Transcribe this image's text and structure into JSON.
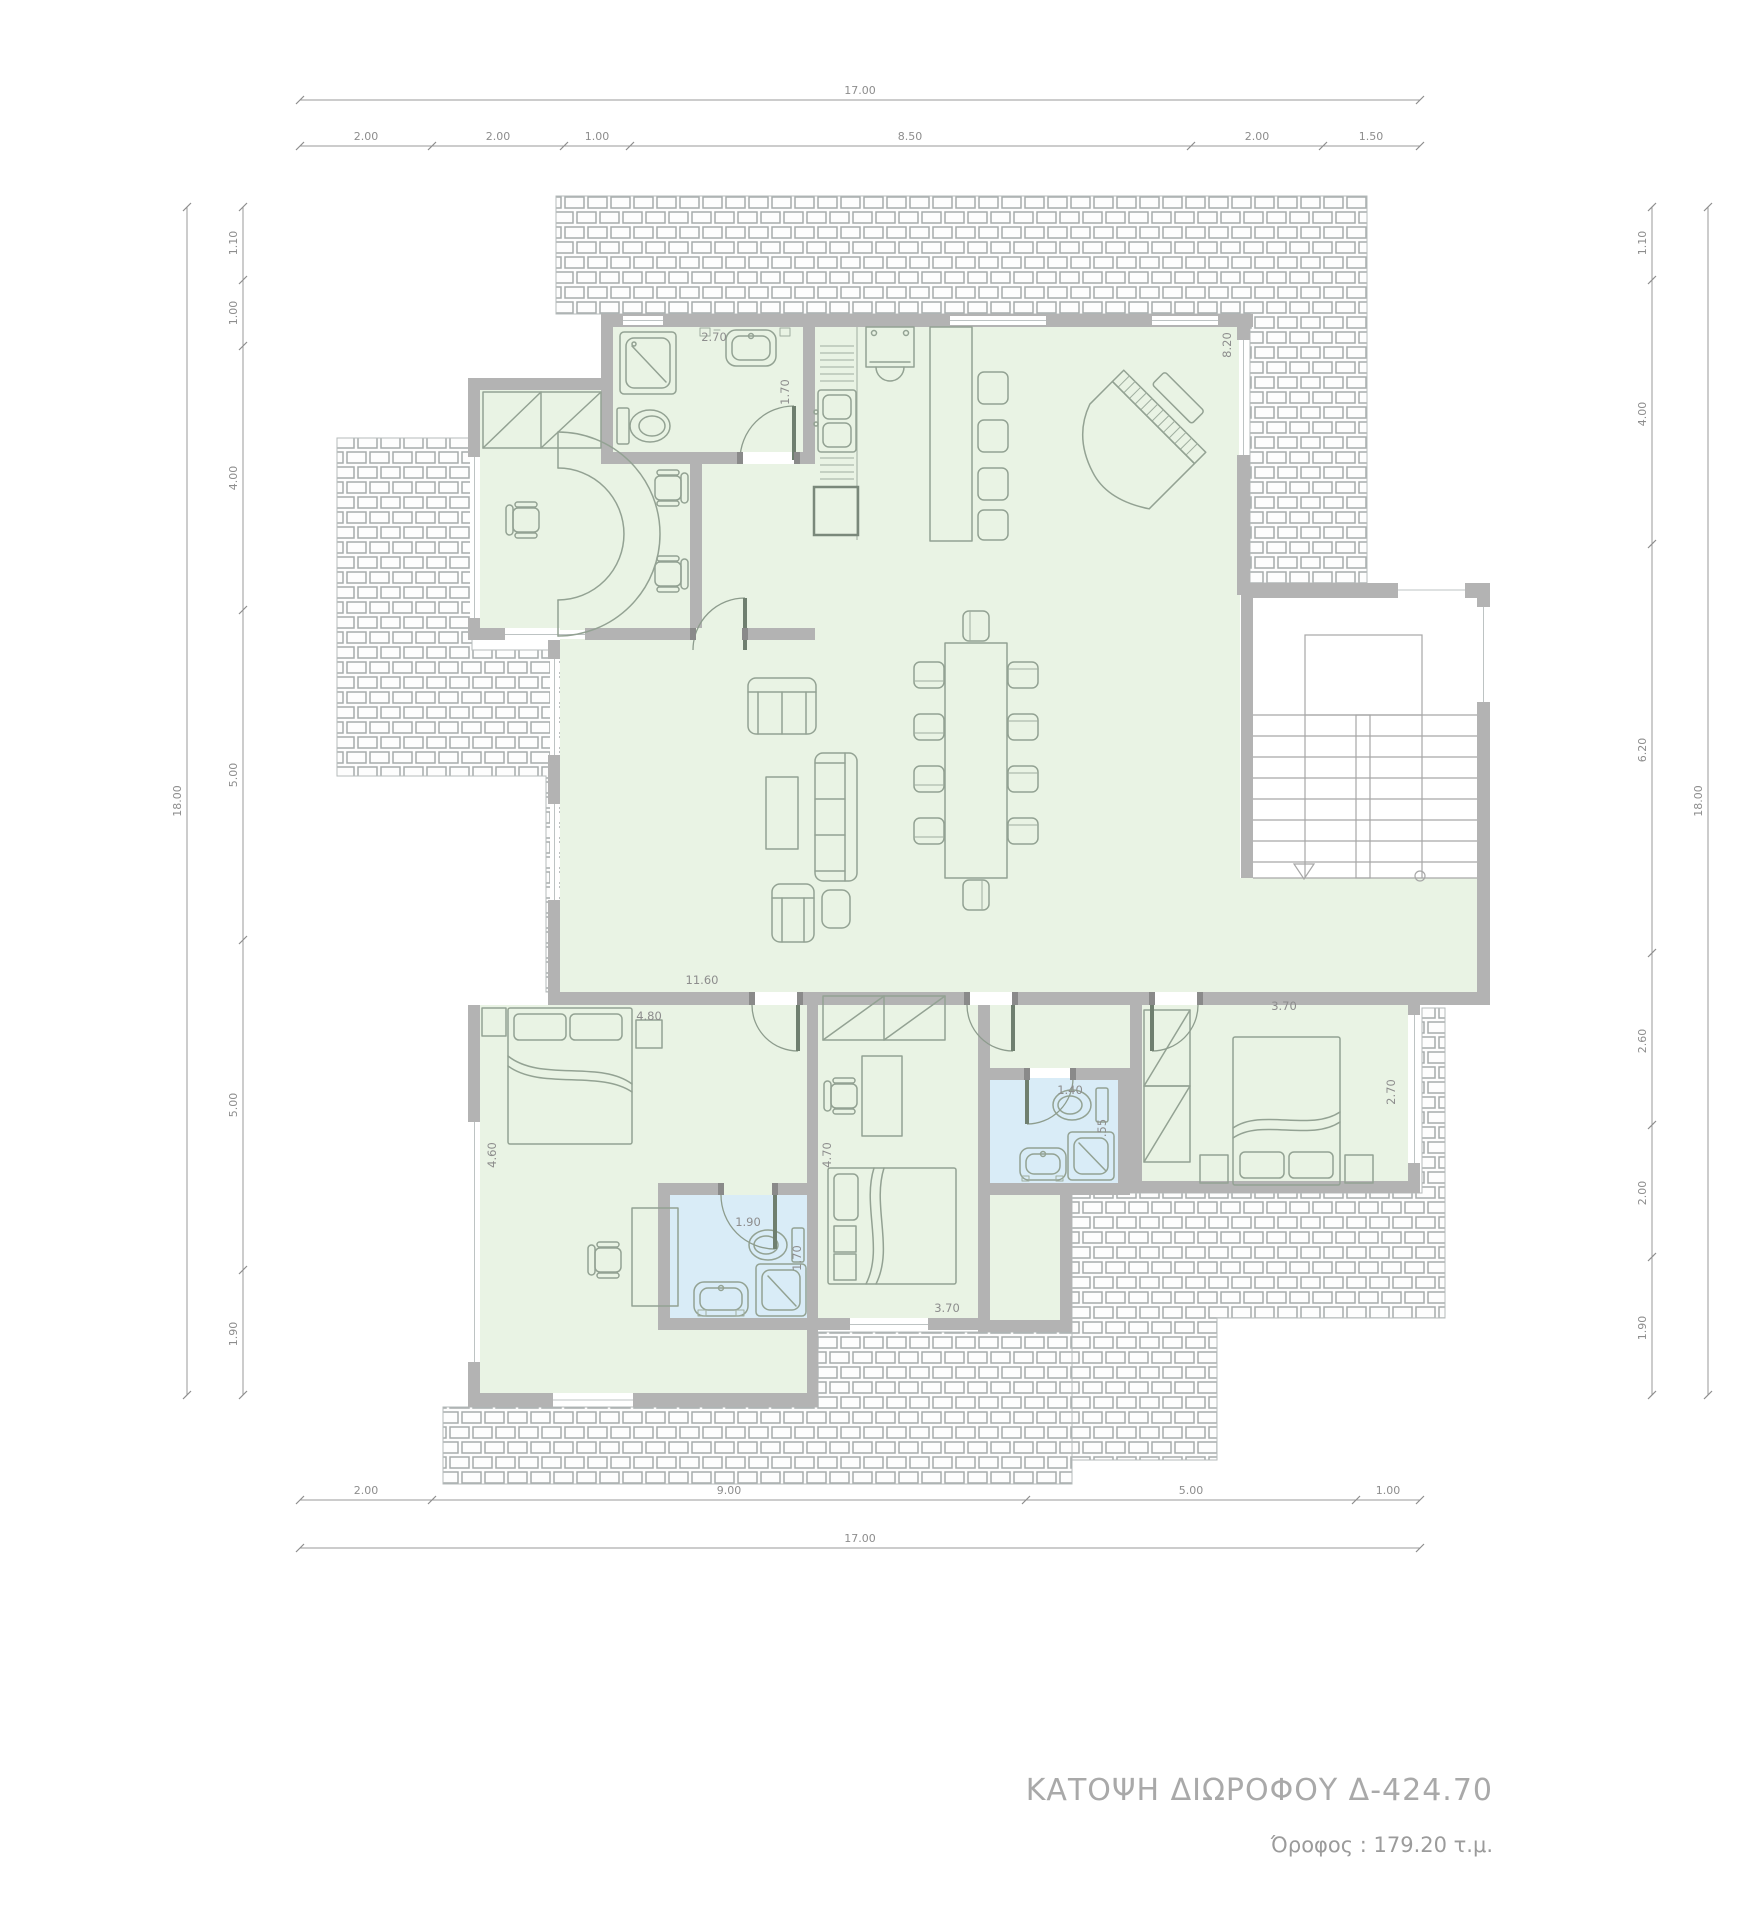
{
  "title": {
    "text": "ΚΑΤΟΨΗ ΔΙΩΡΟΦΟΥ Δ-424.70",
    "subtitle": "Όροφος : 179.20 τ.μ."
  },
  "colors": {
    "room_fill": "#e9f3e4",
    "bath_fill": "#d9ecf7",
    "wall": "#b3b3b3",
    "dimension": "#8d8d8d",
    "furniture": "#93a293",
    "title": "#a9a9a9"
  },
  "dimensions": {
    "top": {
      "overall": "17.00",
      "segments": [
        "2.00",
        "2.00",
        "1.00",
        "8.50",
        "2.00",
        "1.50"
      ]
    },
    "bottom": {
      "overall": "17.00",
      "segments": [
        "2.00",
        "9.00",
        "5.00",
        "1.00"
      ]
    },
    "left": {
      "overall": "18.00",
      "segments": [
        "1.10",
        "1.00",
        "4.00",
        "5.00",
        "5.00",
        "1.90"
      ]
    },
    "right": {
      "overall": "18.00",
      "segments": [
        "1.10",
        "4.00",
        "6.20",
        "2.60",
        "2.00",
        "1.90"
      ]
    }
  },
  "interior_labels": {
    "bath_top_width": "2.70",
    "bath_top_door": "1.70",
    "living_height": "8.20",
    "living_width": "11.60",
    "bedroom_left_width": "4.80",
    "bedroom_left_height": "4.60",
    "bath_left_door": "1.90",
    "bath_left_shower": "1.70",
    "bedroom_mid_height": "4.70",
    "bedroom_mid_width": "3.70",
    "bath_mid_width": "1.40",
    "bath_mid_depth": ".55",
    "bedroom_right_width": "3.70",
    "bedroom_right_height": "2.70"
  }
}
